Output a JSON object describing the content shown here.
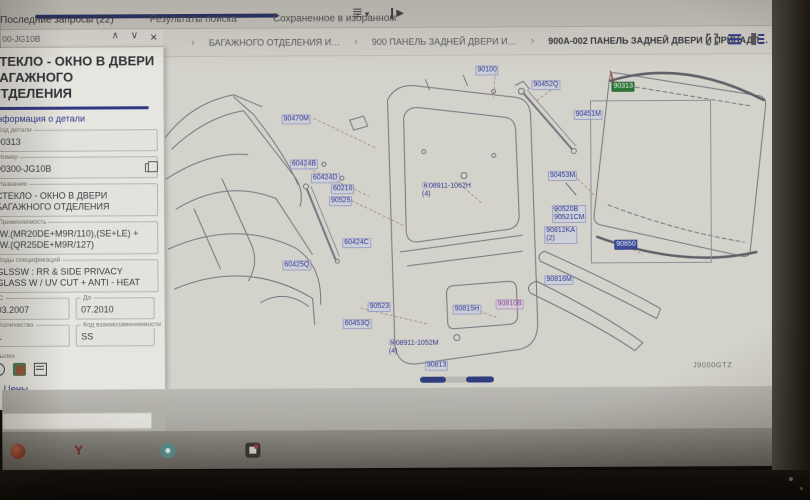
{
  "topbar": {
    "tabs": [
      {
        "label": "Последние запросы (22)",
        "active": true
      },
      {
        "label": "Результаты поиска"
      },
      {
        "label": "Сохраненное в избранном"
      }
    ]
  },
  "icons": {
    "menu": "≣",
    "caret_down": "▾",
    "play": "▶",
    "chevron_up": "∧",
    "chevron_down": "∨",
    "close": "×",
    "breadcrumb_sep": "›",
    "prices_chevron": "∨"
  },
  "breadcrumb": {
    "items": [
      {
        "label": "БАГАЖНОГО ОТДЕЛЕНИЯ И…"
      },
      {
        "label": "900 ПАНЕЛЬ ЗАДНЕЙ ДВЕРИ И…"
      },
      {
        "label": "900A-002 ПАНЕЛЬ ЗАДНЕЙ ДВЕРИ И ПРИНАДЛ…",
        "current": true
      }
    ]
  },
  "part_panel": {
    "nav_code": "00-JG10B",
    "title": "СТЕКЛО - ОКНО В ДВЕРИ БАГАЖНОГО ОТДЕЛЕНИЯ",
    "tab_label": "Информация о детали",
    "fields": [
      {
        "label": "Код детали",
        "value": "90313"
      },
      {
        "label": "Номер",
        "value": "90300-JG10B",
        "copy": true
      },
      {
        "label": "Название",
        "value": "СТЕКЛО - ОКНО В ДВЕРИ БАГАЖНОГО ОТДЕЛЕНИЯ"
      },
      {
        "label": "Применяемость",
        "value": "*W.(MR20DE+M9R/110),(SE+LE) + *W.(QR25DE+M9R/127)"
      },
      {
        "label": "Коды спецификаций",
        "value": "GLSSW : RR & SIDE PRIVACY GLASS W / UV CUT + ANTI - HEAT"
      },
      {
        "label": "С",
        "value": "03.2007",
        "half": true
      },
      {
        "label": "До",
        "value": "07.2010",
        "half": true
      },
      {
        "label": "Количество",
        "value": "1",
        "half": true
      },
      {
        "label": "Код взаимозаменяемости",
        "value": "SS",
        "half": true
      }
    ],
    "links_label": "Ссылки",
    "prices_label": "Цены"
  },
  "diagram": {
    "drawing_code": "J9000GTZ",
    "labels": [
      {
        "t": "90470M",
        "x": 118,
        "y": 58
      },
      {
        "t": "60424B",
        "x": 126,
        "y": 103
      },
      {
        "t": "60424D",
        "x": 147,
        "y": 117
      },
      {
        "t": "60210",
        "x": 167,
        "y": 128
      },
      {
        "t": "90525",
        "x": 165,
        "y": 140
      },
      {
        "t": "60424C",
        "x": 178,
        "y": 182
      },
      {
        "t": "60425Q",
        "x": 118,
        "y": 204
      },
      {
        "t": "90523",
        "x": 203,
        "y": 246
      },
      {
        "t": "60453Q",
        "x": 178,
        "y": 263
      },
      {
        "t": "90815H",
        "x": 288,
        "y": 249
      },
      {
        "t": "90810B",
        "x": 331,
        "y": 244,
        "cls": "visited"
      },
      {
        "t": "Ⓝ08911-1052M",
        "t2": "(4)",
        "x": 222,
        "y": 283,
        "cls": "plain"
      },
      {
        "t": "90813",
        "x": 260,
        "y": 305
      },
      {
        "t": "90100",
        "x": 312,
        "y": 10
      },
      {
        "t": "90452Q",
        "x": 368,
        "y": 25
      },
      {
        "t": "Ⓝ08911-1062H",
        "t2": "(4)",
        "x": 256,
        "y": 126,
        "cls": "plain"
      },
      {
        "t": "90451M",
        "x": 410,
        "y": 55
      },
      {
        "t": "90453M",
        "x": 384,
        "y": 116
      },
      {
        "t": "90520B",
        "t2": "90521CM",
        "x": 388,
        "y": 150
      },
      {
        "t": "90812KA",
        "t2": "(2)",
        "x": 380,
        "y": 171
      },
      {
        "t": "90850",
        "x": 450,
        "y": 185,
        "cls": "selected"
      },
      {
        "t": "90816M",
        "x": 380,
        "y": 220
      },
      {
        "t": "90313",
        "x": 448,
        "y": 27,
        "cls": "green"
      }
    ]
  },
  "colors": {
    "accent_navy": "#1d2b6e",
    "link_blue": "#2a35a0",
    "selected_green": "#1f7a2e",
    "selected_blue": "#3949ab"
  }
}
